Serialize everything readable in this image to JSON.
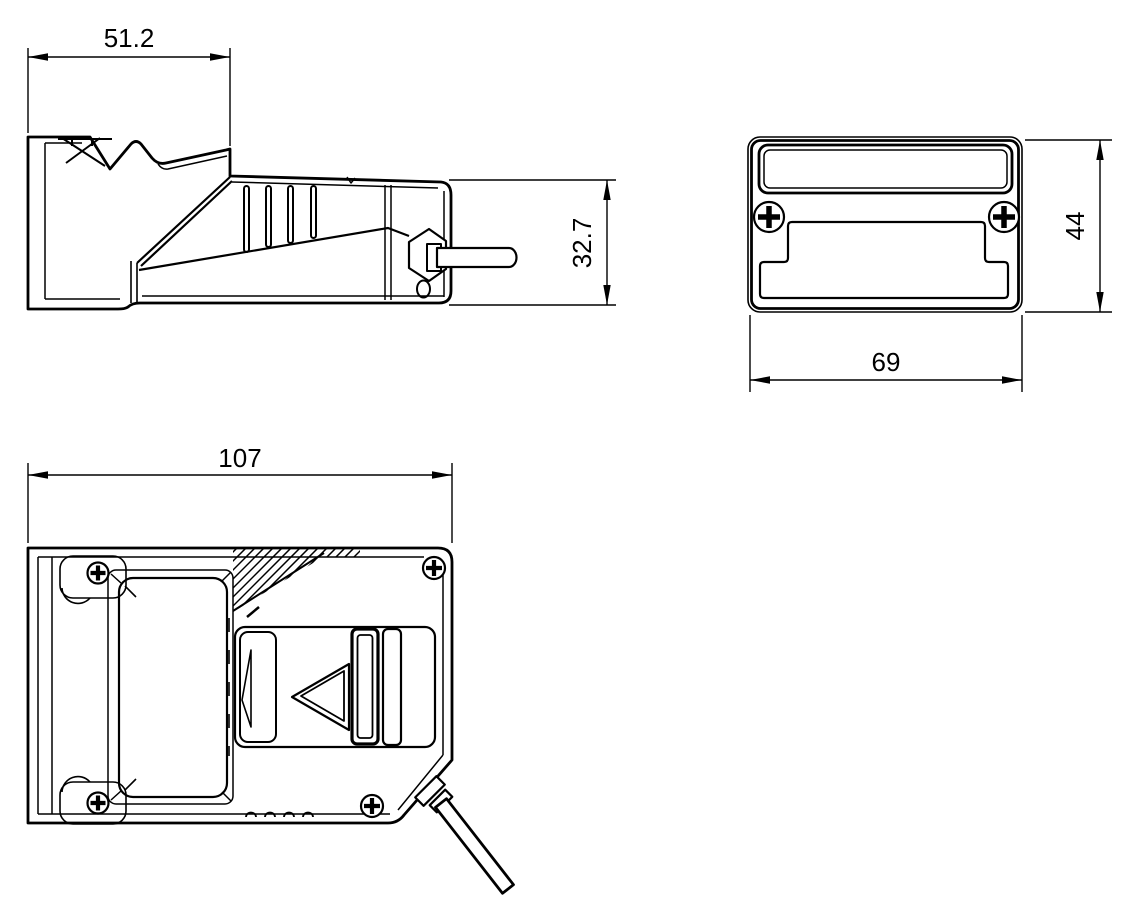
{
  "drawing": {
    "kind": "technical-dimension-drawing",
    "background": "#ffffff",
    "ink": "#000000",
    "views": {
      "side": {
        "dims": {
          "width": "51.2",
          "height": "32.7"
        }
      },
      "front": {
        "dims": {
          "width": "69",
          "height": "44"
        }
      },
      "top": {
        "dims": {
          "width": "107"
        }
      }
    },
    "icons": {
      "screw": "phillips-cross-in-circle",
      "arrow": "filled-dimension-arrowhead"
    }
  }
}
